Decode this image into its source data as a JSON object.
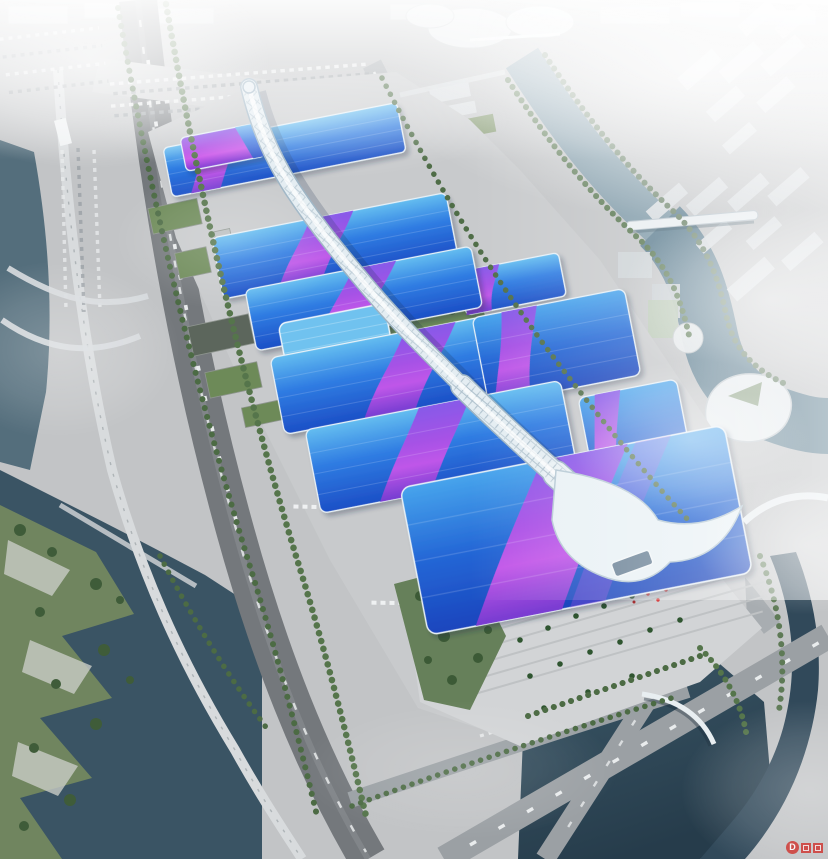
{
  "scene": {
    "description": "Aerial rendering of a vast international exhibition and convention center: a white lattice central concourse tube runs diagonally across parallel blue exhibition halls striped with magenta ribbons, surrounded by boulevards, canals, parks, plazas and a hazy city skyline.",
    "landmarks": [
      {
        "name": "central-concourse",
        "desc": "white diamond-lattice elevated spine tube"
      },
      {
        "name": "exhibition-hall-rows",
        "desc": "blue gradient roofs with magenta S-ribbons"
      },
      {
        "name": "grand-south-hall",
        "desc": "largest hall with wave canopy and entrance"
      },
      {
        "name": "south-entrance-plaza",
        "desc": "stepped plaza with palm trees and red crowd"
      },
      {
        "name": "rooftop-gardens",
        "desc": "green garden strips between halls"
      },
      {
        "name": "west-boulevard",
        "desc": "tree-lined arterial road"
      },
      {
        "name": "elevated-viaduct",
        "desc": "light rail viaduct along west river"
      },
      {
        "name": "north-parking-lot",
        "desc": "striped lot with parked cars"
      },
      {
        "name": "logistics-warehouses",
        "desc": "green-roof service sheds on west apron"
      },
      {
        "name": "canal",
        "desc": "river canal winding along the east side"
      },
      {
        "name": "bottom-left-lake",
        "desc": "dark water with angular riverside park"
      },
      {
        "name": "bottom-right-pond",
        "desc": "dark pond with arc footbridge"
      },
      {
        "name": "curvy-landmark-building",
        "desc": "white S-shaped building by the canal"
      },
      {
        "name": "city-blocks",
        "desc": "hazy white city towers and slabs"
      }
    ],
    "palette": {
      "roof_cyan": "#5cb9ee",
      "roof_blue": "#2f7ce2",
      "roof_deep_blue": "#1c4fc6",
      "ribbon_magenta": "#cc55ea",
      "ribbon_purple": "#8a52e8",
      "spine_white": "#e4edf2",
      "ground_concrete": "#c6c8ca",
      "road_asphalt": "#74787c",
      "water_dark": "#2b4253",
      "water_canal": "#6e8d9e",
      "tree_green": "#4f6d47",
      "haze_white": "#ffffff",
      "crowd_red": "#d84545"
    }
  },
  "watermark": {
    "label": "D"
  }
}
